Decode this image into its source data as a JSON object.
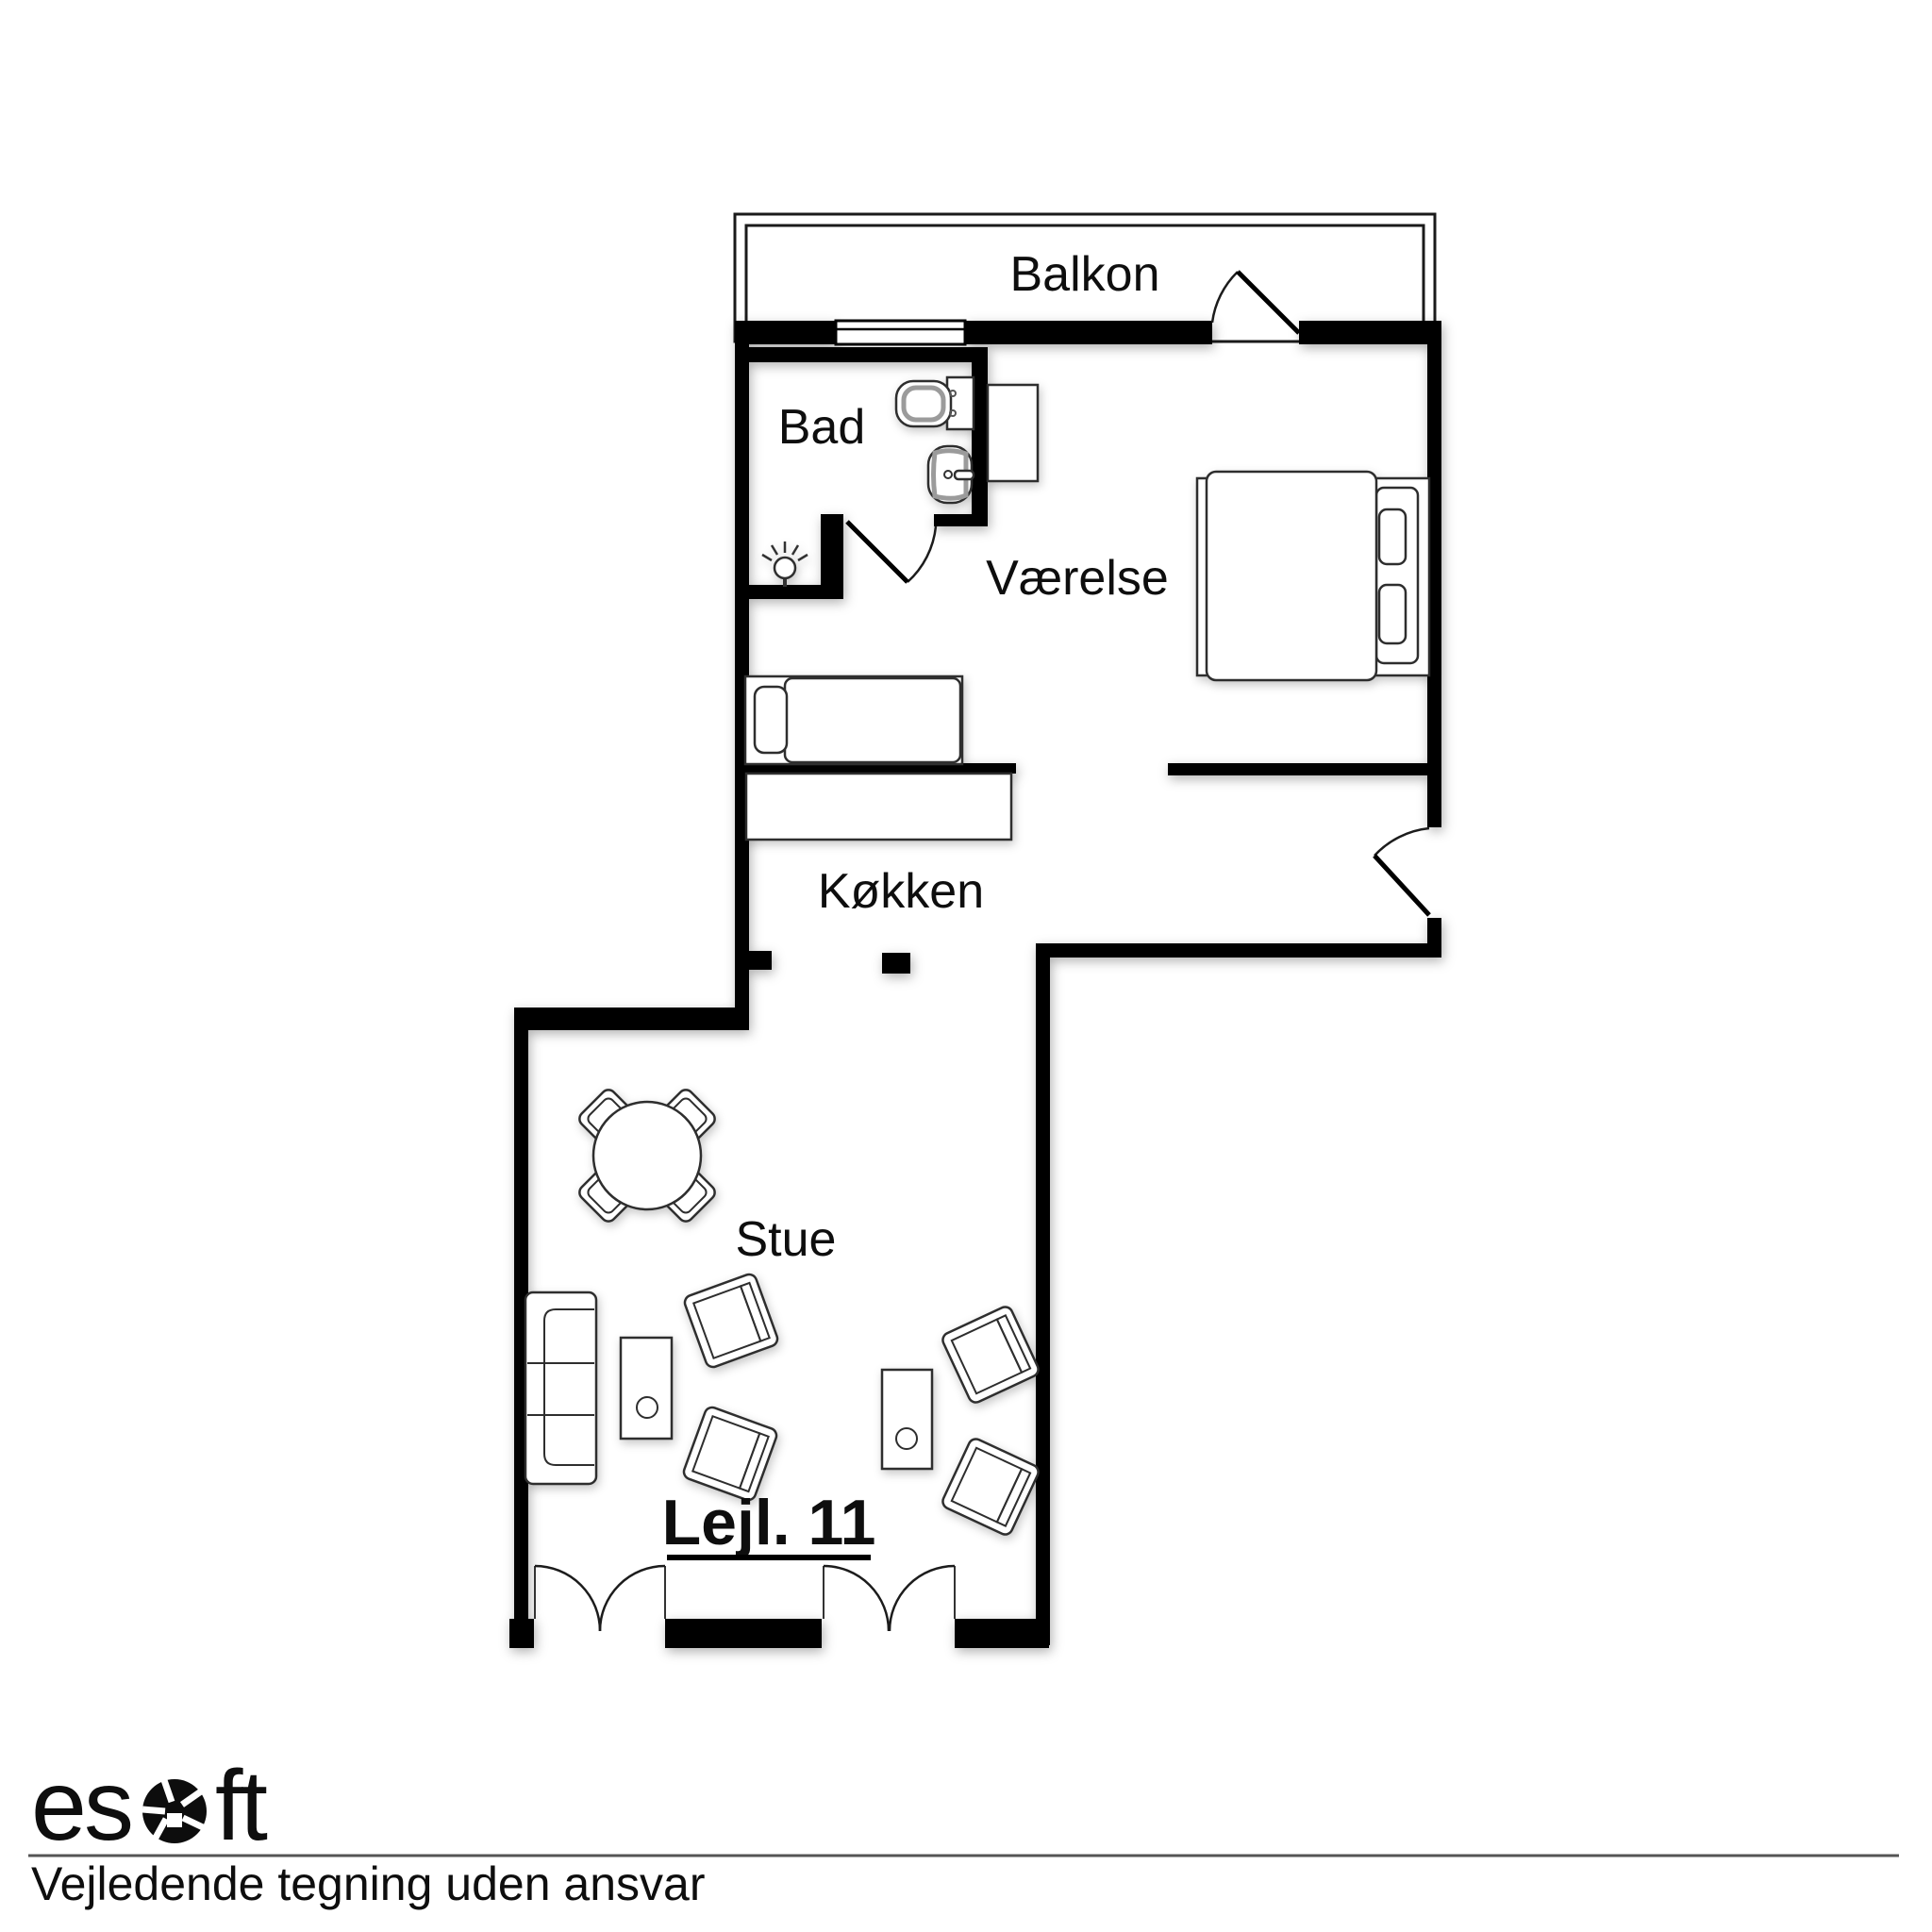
{
  "floorplan": {
    "unit_label": "Lejl. 11",
    "rooms": [
      {
        "id": "balkon",
        "label": "Balkon"
      },
      {
        "id": "bad",
        "label": "Bad"
      },
      {
        "id": "vaerelse",
        "label": "Værelse"
      },
      {
        "id": "koekken",
        "label": "Køkken"
      },
      {
        "id": "stue",
        "label": "Stue"
      }
    ]
  },
  "footer": {
    "brand": "esoft",
    "brand_left": "es",
    "brand_right": "ft",
    "disclaimer": "Vejledende tegning uden ansvar"
  },
  "colors": {
    "wall": "#000000",
    "background": "#ffffff",
    "line": "#2e2e2e",
    "fixture": "#9b9b9b",
    "text": "#0e0e0e",
    "rule": "#555555"
  }
}
